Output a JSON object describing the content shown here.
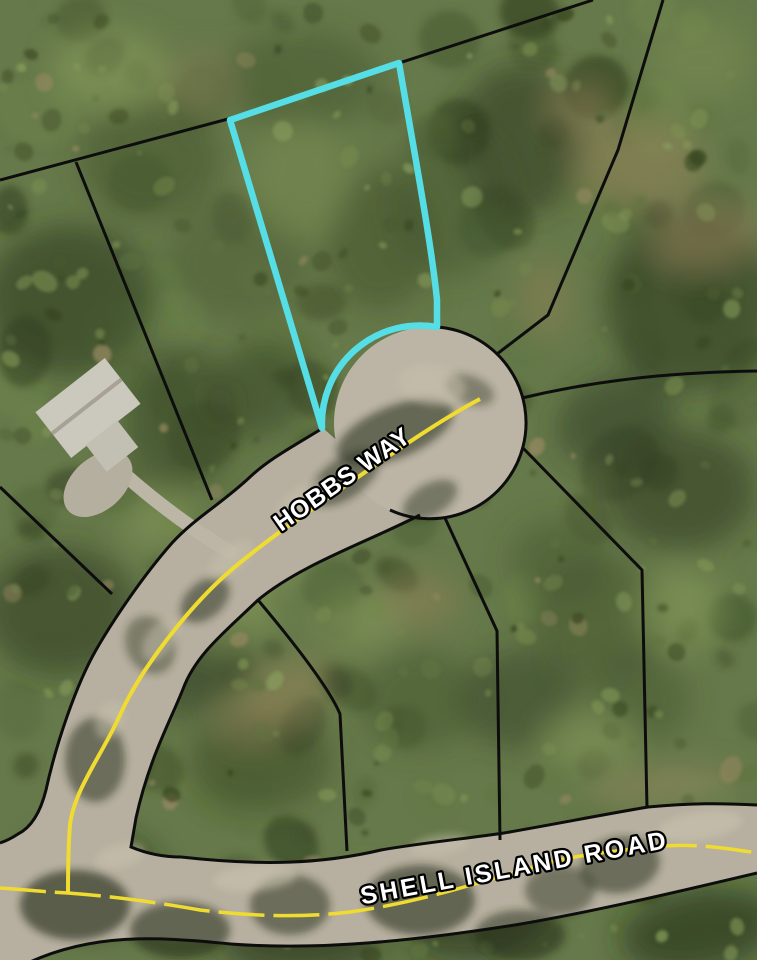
{
  "map": {
    "labels": {
      "hobbs_way": "HOBBS WAY",
      "shell_island_road": "SHELL ISLAND ROAD"
    },
    "colors": {
      "parcel_highlight": "#55DEE6",
      "centerline_yellow": "#F0DC30",
      "boundary_black": "#0d0d0d",
      "road_surface": "#B7B0A0",
      "culdesac_surface": "#BCB5A6",
      "label_fill": "#FFFFFF",
      "label_outline": "#000000"
    }
  }
}
